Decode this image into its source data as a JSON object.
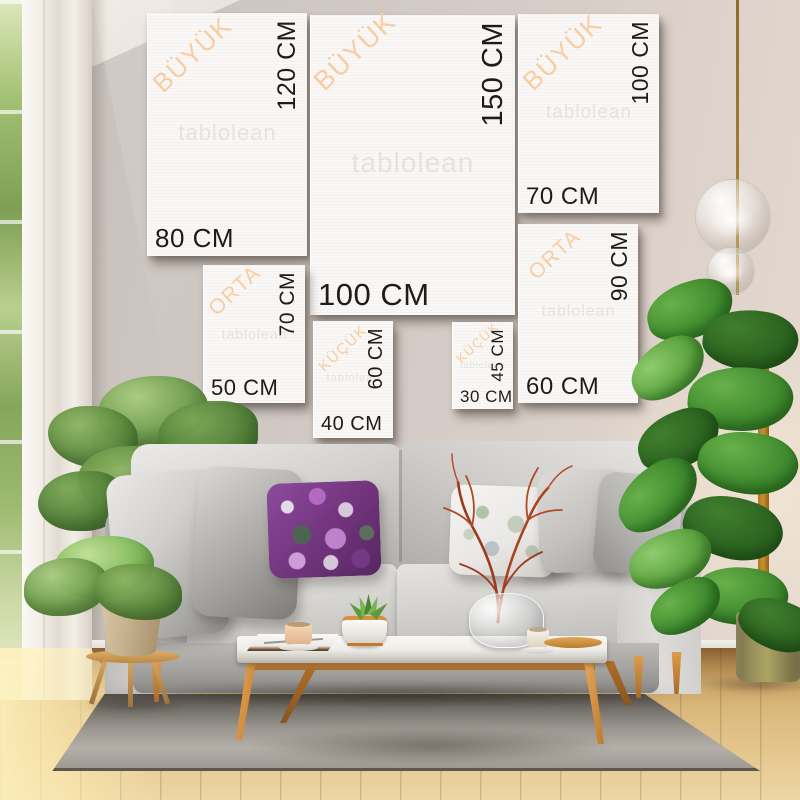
{
  "watermark": "tablolean",
  "size_guide": {
    "unit": "CM",
    "frames": [
      {
        "name": "canvas-80x120",
        "category": "BÜYÜK",
        "width_label": "80 CM",
        "height_label": "120 CM"
      },
      {
        "name": "canvas-100x150",
        "category": "BÜYÜK",
        "width_label": "100 CM",
        "height_label": "150 CM"
      },
      {
        "name": "canvas-70x100",
        "category": "BÜYÜK",
        "width_label": "70 CM",
        "height_label": "100 CM"
      },
      {
        "name": "canvas-50x70",
        "category": "ORTA",
        "width_label": "50 CM",
        "height_label": "70 CM"
      },
      {
        "name": "canvas-40x60",
        "category": "KÜÇÜK",
        "width_label": "40 CM",
        "height_label": "60 CM"
      },
      {
        "name": "canvas-30x45",
        "category": "KÜÇÜK",
        "width_label": "30 CM",
        "height_label": "45 CM"
      },
      {
        "name": "canvas-60x90",
        "category": "ORTA",
        "width_label": "60 CM",
        "height_label": "90 CM"
      }
    ]
  },
  "colors": {
    "category_label_accent": "#f7cda1",
    "dimension_text": "#1d1c1b",
    "canvas_white": "#f9f8f6",
    "wall": "#d2cac5",
    "floor_wood": "#dbb97e",
    "sofa_gray": "#c8c6c3",
    "rug_gray": "#a9a49d",
    "wood_accent": "#cd8a3e",
    "plant_green": "#4f8a38",
    "pillow_purple": "#74357f"
  }
}
